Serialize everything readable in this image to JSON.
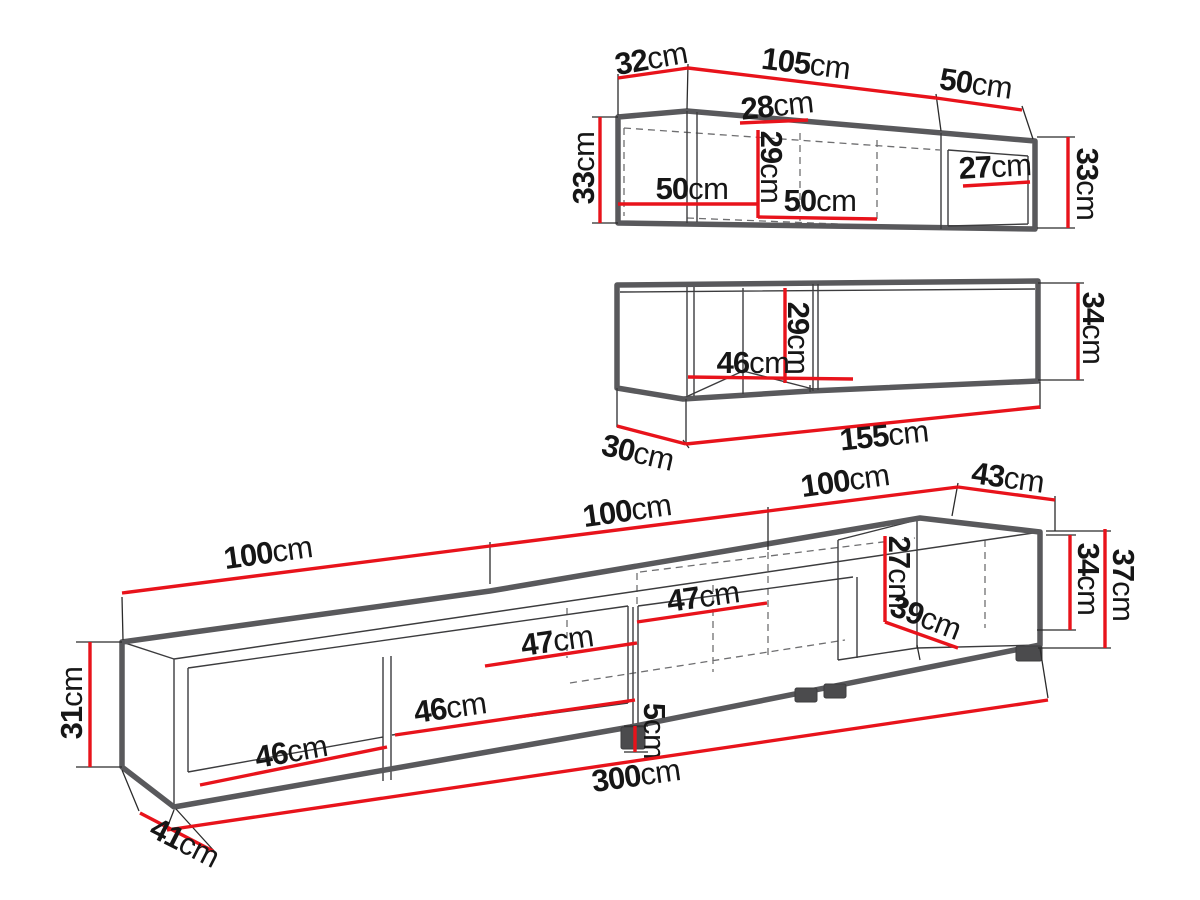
{
  "canvas": {
    "width": 1200,
    "height": 900
  },
  "units": "cm",
  "colors": {
    "background": "#ffffff",
    "dimension_red": "#e8131b",
    "outline_gray": "#59595c",
    "text_black": "#161616"
  },
  "pieces": [
    {
      "id": "wall-cabinet-a",
      "description": "upper wall cabinet drawing",
      "dimension_values": [
        "32cm",
        "105cm",
        "50cm",
        "33cm",
        "28cm",
        "29cm",
        "50cm",
        "50cm",
        "27cm",
        "33cm"
      ]
    },
    {
      "id": "wall-cabinet-b",
      "description": "middle wall cabinet drawing",
      "dimension_values": [
        "29cm",
        "46cm",
        "34cm",
        "30cm",
        "155cm"
      ]
    },
    {
      "id": "tv-stand",
      "description": "long TV stand drawing",
      "dimension_values": [
        "100cm",
        "100cm",
        "100cm",
        "43cm",
        "31cm",
        "34cm",
        "37cm",
        "27cm",
        "39cm",
        "47cm",
        "47cm",
        "46cm",
        "46cm",
        "5cm",
        "300cm",
        "41cm"
      ]
    }
  ],
  "dimensions": [
    {
      "piece": "wall-cabinet-a",
      "value": "32",
      "unit": "cm",
      "line": [
        618,
        78,
        688,
        68
      ],
      "x": 651,
      "y": 58,
      "rot": -10
    },
    {
      "piece": "wall-cabinet-a",
      "value": "105",
      "unit": "cm",
      "line": [
        688,
        68,
        936,
        98
      ],
      "x": 806,
      "y": 63,
      "rot": 7
    },
    {
      "piece": "wall-cabinet-a",
      "value": "50",
      "unit": "cm",
      "line": [
        936,
        98,
        1022,
        110
      ],
      "x": 976,
      "y": 83,
      "rot": 8
    },
    {
      "piece": "wall-cabinet-a",
      "value": "33",
      "unit": "cm",
      "line": [
        600,
        117,
        600,
        223
      ],
      "x": 583,
      "y": 168,
      "rot": -90
    },
    {
      "piece": "wall-cabinet-a",
      "value": "28",
      "unit": "cm",
      "line": [
        740,
        123,
        808,
        120
      ],
      "x": 777,
      "y": 105,
      "rot": -6
    },
    {
      "piece": "wall-cabinet-a",
      "value": "29",
      "unit": "cm",
      "line": [
        758,
        130,
        758,
        218
      ],
      "x": 772,
      "y": 167,
      "rot": 90
    },
    {
      "piece": "wall-cabinet-a",
      "value": "50",
      "unit": "cm",
      "line": [
        618,
        204,
        757,
        204
      ],
      "x": 692,
      "y": 188,
      "rot": 0
    },
    {
      "piece": "wall-cabinet-a",
      "value": "50",
      "unit": "cm",
      "line": [
        758,
        217,
        877,
        219
      ],
      "x": 820,
      "y": 200,
      "rot": 0
    },
    {
      "piece": "wall-cabinet-a",
      "value": "27",
      "unit": "cm",
      "line": [
        963,
        186,
        1030,
        182
      ],
      "x": 995,
      "y": 166,
      "rot": -3
    },
    {
      "piece": "wall-cabinet-a",
      "value": "33",
      "unit": "cm",
      "line": [
        1068,
        137,
        1068,
        228
      ],
      "x": 1088,
      "y": 184,
      "rot": 90
    },
    {
      "piece": "wall-cabinet-b",
      "value": "29",
      "unit": "cm",
      "line": [
        785,
        288,
        785,
        383
      ],
      "x": 799,
      "y": 338,
      "rot": 90
    },
    {
      "piece": "wall-cabinet-b",
      "value": "46",
      "unit": "cm",
      "line": [
        688,
        377,
        853,
        379
      ],
      "x": 753,
      "y": 362,
      "rot": 0
    },
    {
      "piece": "wall-cabinet-b",
      "value": "34",
      "unit": "cm",
      "line": [
        1078,
        283,
        1078,
        380
      ],
      "x": 1094,
      "y": 328,
      "rot": 90
    },
    {
      "piece": "wall-cabinet-b",
      "value": "30",
      "unit": "cm",
      "line": [
        617,
        426,
        686,
        444
      ],
      "x": 638,
      "y": 452,
      "rot": 13
    },
    {
      "piece": "wall-cabinet-b",
      "value": "155",
      "unit": "cm",
      "line": [
        686,
        444,
        1040,
        407
      ],
      "x": 884,
      "y": 435,
      "rot": -6
    },
    {
      "piece": "tv-stand",
      "value": "100",
      "unit": "cm",
      "line": [
        122,
        593,
        490,
        546
      ],
      "x": 268,
      "y": 552,
      "rot": -8
    },
    {
      "piece": "tv-stand",
      "value": "100",
      "unit": "cm",
      "line": [
        490,
        546,
        768,
        511
      ],
      "x": 627,
      "y": 510,
      "rot": -8
    },
    {
      "piece": "tv-stand",
      "value": "100",
      "unit": "cm",
      "line": [
        768,
        511,
        958,
        487
      ],
      "x": 845,
      "y": 480,
      "rot": -8
    },
    {
      "piece": "tv-stand",
      "value": "43",
      "unit": "cm",
      "line": [
        958,
        487,
        1055,
        500
      ],
      "x": 1008,
      "y": 477,
      "rot": 8
    },
    {
      "piece": "tv-stand",
      "value": "31",
      "unit": "cm",
      "line": [
        90,
        642,
        90,
        767
      ],
      "x": 71,
      "y": 703,
      "rot": -90
    },
    {
      "piece": "tv-stand",
      "value": "34",
      "unit": "cm",
      "line": [
        1070,
        535,
        1070,
        630
      ],
      "x": 1089,
      "y": 579,
      "rot": 90
    },
    {
      "piece": "tv-stand",
      "value": "37",
      "unit": "cm",
      "line": [
        1105,
        529,
        1105,
        648
      ],
      "x": 1124,
      "y": 585,
      "rot": 90
    },
    {
      "piece": "tv-stand",
      "value": "27",
      "unit": "cm",
      "line": [
        885,
        536,
        885,
        622
      ],
      "x": 900,
      "y": 572,
      "rot": 90
    },
    {
      "piece": "tv-stand",
      "value": "39",
      "unit": "cm",
      "line": [
        885,
        622,
        958,
        648
      ],
      "x": 926,
      "y": 617,
      "rot": 21
    },
    {
      "piece": "tv-stand",
      "value": "47",
      "unit": "cm",
      "line": [
        637,
        622,
        767,
        603
      ],
      "x": 703,
      "y": 596,
      "rot": -8
    },
    {
      "piece": "tv-stand",
      "value": "47",
      "unit": "cm",
      "line": [
        485,
        666,
        637,
        643
      ],
      "x": 557,
      "y": 640,
      "rot": -8
    },
    {
      "piece": "tv-stand",
      "value": "46",
      "unit": "cm",
      "line": [
        395,
        735,
        635,
        700
      ],
      "x": 450,
      "y": 707,
      "rot": -8
    },
    {
      "piece": "tv-stand",
      "value": "46",
      "unit": "cm",
      "line": [
        200,
        785,
        387,
        747
      ],
      "x": 291,
      "y": 751,
      "rot": -10
    },
    {
      "piece": "tv-stand",
      "value": "5",
      "unit": "cm",
      "line": [
        635,
        726,
        635,
        752
      ],
      "x": 655,
      "y": 731,
      "rot": 90
    },
    {
      "piece": "tv-stand",
      "value": "300",
      "unit": "cm",
      "line": [
        167,
        830,
        1048,
        700
      ],
      "x": 636,
      "y": 775,
      "rot": -8
    },
    {
      "piece": "tv-stand",
      "value": "41",
      "unit": "cm",
      "line": [
        140,
        813,
        213,
        851
      ],
      "x": 185,
      "y": 842,
      "rot": 27
    }
  ]
}
